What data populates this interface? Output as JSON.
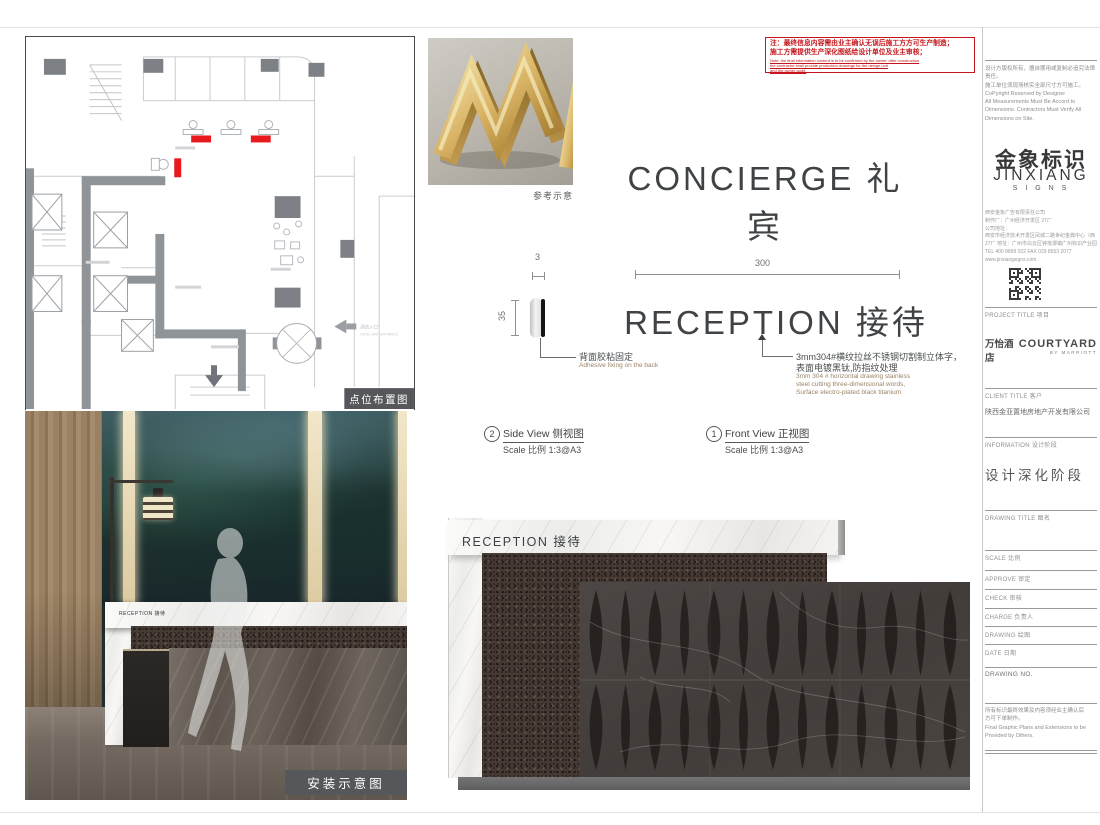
{
  "plan_panel": {
    "caption": "点位布置图",
    "entrance_cn": "酒店入口",
    "entrance_en": "HOTEL MAIN ENTRANCE",
    "marker_color": "#e8191c"
  },
  "reference": {
    "caption": "参考示意"
  },
  "production_note": {
    "cn1": "注：最终信息内容需由业主确认无误后施工方方可生产制造；",
    "cn2": "施工方需提供生产深化图纸给设计单位及业主审核；",
    "en1": "Note: the final information content is to be confirmed by the owner, after construction",
    "en2": "the contractor shall provide production drawings for the design unit",
    "en3": "and the owner audit."
  },
  "headline": {
    "text": "CONCIERGE 礼宾"
  },
  "drawing": {
    "dim_width": "300",
    "dim_depth": "3",
    "dim_height": "35",
    "sign_text": "RECEPTION 接待",
    "back_fix_cn": "背面胶粘固定",
    "back_fix_en": "Adhesive fixing on the back",
    "material_cn1": "3mm304#横纹拉丝不锈钢切割制立体字，",
    "material_cn2": "表面电镀黑钛,防指纹处理",
    "material_en1": "3mm 304 # horizontal drawing stainless",
    "material_en2": "steel cutting three-dimensional words,",
    "material_en3": "Surface electro-plated black titanium",
    "side_view": {
      "num": "2",
      "title": "Side View  侧视图",
      "scale_label": "Scale 比例",
      "scale_value": "1:3@A3"
    },
    "front_view": {
      "num": "1",
      "title": "Front View  正视图",
      "scale_label": "Scale 比例",
      "scale_value": "1:3@A3"
    }
  },
  "elevation": {
    "sign_text": "RECEPTION 接待"
  },
  "install_panel": {
    "caption": "安装示意图",
    "desk_sign": "RECEPTION 接待"
  },
  "titleblock": {
    "copyright_lines": [
      "设计方版权所有，擅自挪用或复制必追究法律责任。",
      "施工单位须现场核实全部尺寸方可施工。",
      "CoPyright Reserved by Designer",
      "All Measurements Must Be Accord to",
      "Dimensions. Contractors Must Verify All",
      "Dimensions on Site."
    ],
    "brand_cn": "金象标识",
    "brand_en": "JINXIANG",
    "brand_sub": "S I G N S",
    "address_lines": [
      "西安金象广告有限责任公司",
      "制作厂：广州经济开发区 27厂",
      "公司地址：",
      "西安市经济技术开发区凤城二路世纪金典中心（西",
      "27厂 地址：广州市白云区钟落潭镇广州标识产业园",
      "TEL 400 8899 022  FAX 029 8653 2077",
      "www.jinxiangsigns.com"
    ],
    "project_label": "PROJECT TITLE 项目",
    "project_name_cn": "万怡酒店",
    "project_name_en": "COURTYARD",
    "project_name_sub": "BY MARRIOTT",
    "client_label": "CLIENT TITLE 客户",
    "client_name": "陕西金亚置地房地产开发有限公司",
    "info_label": "INFORMATION 设计阶段",
    "phase": "设计深化阶段",
    "drawing_title_label": "DRAWING TITLE 图名",
    "row_labels": [
      "SCALE 比例",
      "APPROVE 审定",
      "CHECK 审核",
      "CHARGE 负责人",
      "DRAWING 绘图",
      "DATE 日期",
      "DRAWING NO."
    ],
    "footnote_lines": [
      "所有标识最终效果及内容须经业主确认后",
      "方可下单制作。",
      "Final Graphic Plans and Extensions to be",
      "Provided by Others."
    ]
  }
}
